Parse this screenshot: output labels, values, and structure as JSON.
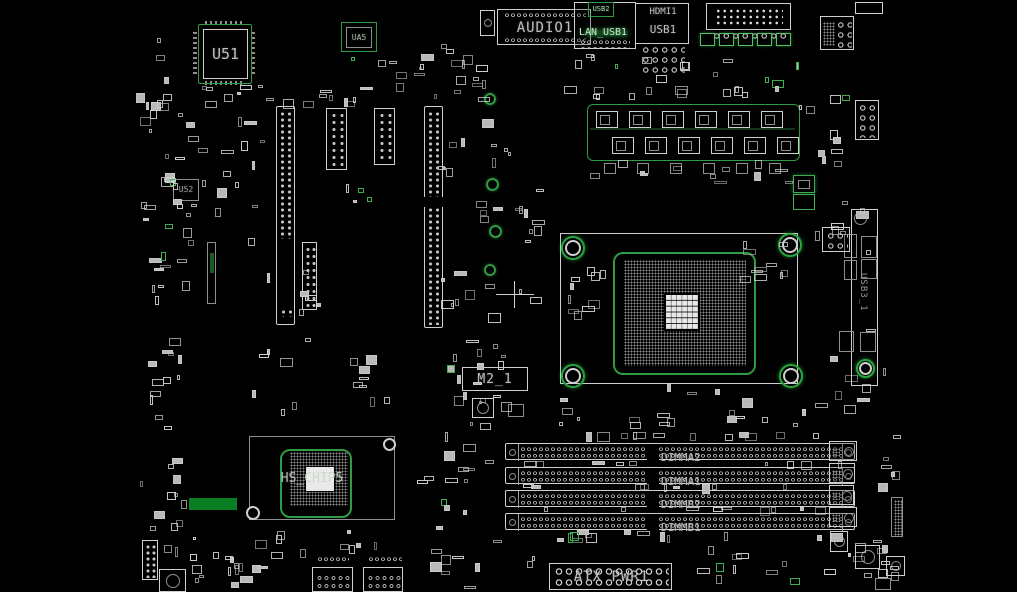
{
  "board": {
    "background": "#000000",
    "silkscreen_color": "#d2d2d2",
    "trace_green": "#2f9b42",
    "bright_green": "#55cc6e",
    "fill_green": "#0a7f22",
    "label_color": "#bdbdbd"
  },
  "chips": {
    "u51": "U51",
    "ua5": "UA5",
    "u52": "U52",
    "chipset_label": "HS_CHIP5"
  },
  "rear_io": {
    "audio": "AUDIO1",
    "lan_usb": "LAN_USB1",
    "usb2": "USB2",
    "hdmi": "HDMI1",
    "usb1": "USB1"
  },
  "sockets": {
    "m2": "M2_1",
    "atx_power": "ATX PWR1",
    "usb3_header": "USB3_1"
  },
  "dimm_slots": [
    {
      "label": "DIMMA2"
    },
    {
      "label": "DIMMA1"
    },
    {
      "label": "DIMMB2"
    },
    {
      "label": "DIMMB1"
    }
  ]
}
